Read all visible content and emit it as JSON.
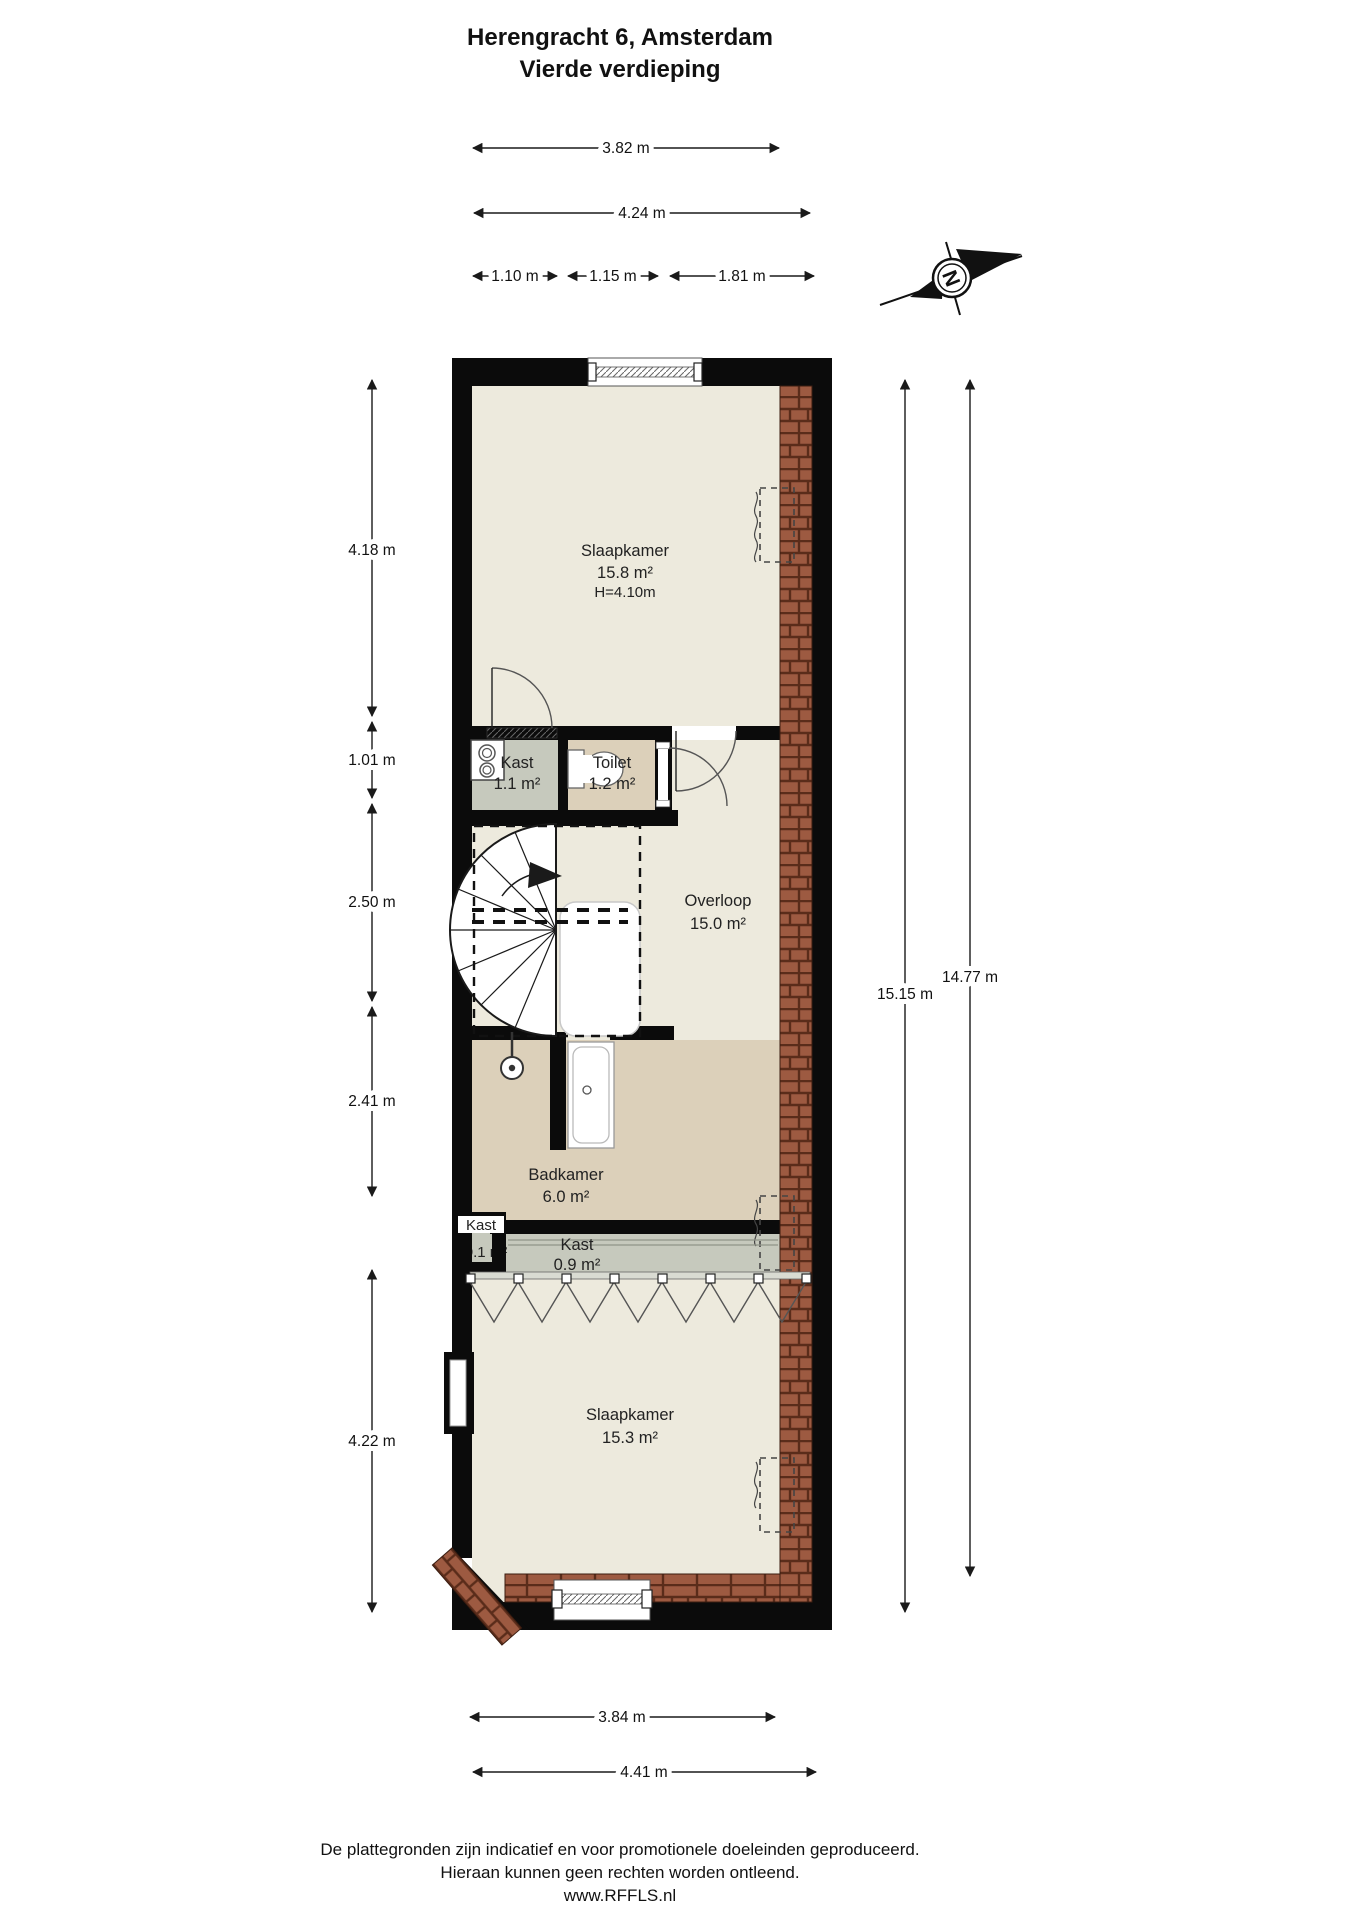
{
  "title": {
    "line1": "Herengracht 6, Amsterdam",
    "line2": "Vierde verdieping"
  },
  "compass": {
    "north_letter": "N"
  },
  "rooms": {
    "slaapkamer_top": {
      "name": "Slaapkamer",
      "area": "15.8 m²",
      "ceiling": "H=4.10m"
    },
    "kast_wasmachine": {
      "name": "Kast",
      "area": "1.1 m²"
    },
    "toilet": {
      "name": "Toilet",
      "area": "1.2 m²"
    },
    "overloop": {
      "name": "Overloop",
      "area": "15.0 m²"
    },
    "badkamer": {
      "name": "Badkamer",
      "area": "6.0 m²"
    },
    "kast_klein": {
      "name": "Kast",
      "area": "0.1 m²"
    },
    "kast_breed": {
      "name": "Kast",
      "area": "0.9 m²"
    },
    "slaapkamer_onder": {
      "name": "Slaapkamer",
      "area": "15.3 m²"
    }
  },
  "dimensions": {
    "width_slaapkamer_top": "3.82 m",
    "width_total_top": "4.24 m",
    "width_kast": "1.10 m",
    "width_toilet": "1.15 m",
    "width_rest": "1.81 m",
    "height_slaapkamer_top": "4.18 m",
    "height_kast_toilet": "1.01 m",
    "height_overloop": "2.50 m",
    "height_badkamer": "2.41 m",
    "height_slaapkamer_onder": "4.22 m",
    "height_total_left": "15.15 m",
    "height_total_right": "14.77 m",
    "width_slaapkamer_onder": "3.84 m",
    "width_total_bottom": "4.41 m"
  },
  "footer": {
    "line1": "De plattegronden zijn indicatief en voor promotionele doeleinden geproduceerd.",
    "line2": "Hieraan kunnen geen rechten worden ontleend.",
    "line3": "www.RFFLS.nl"
  },
  "colors": {
    "wall": "#0b0b0b",
    "room_beige": "#edeadd",
    "room_tan": "#dcd0ba",
    "room_gray": "#c6c9bd",
    "brick": "#9d5a41",
    "brick_line": "#5a2c1a"
  }
}
